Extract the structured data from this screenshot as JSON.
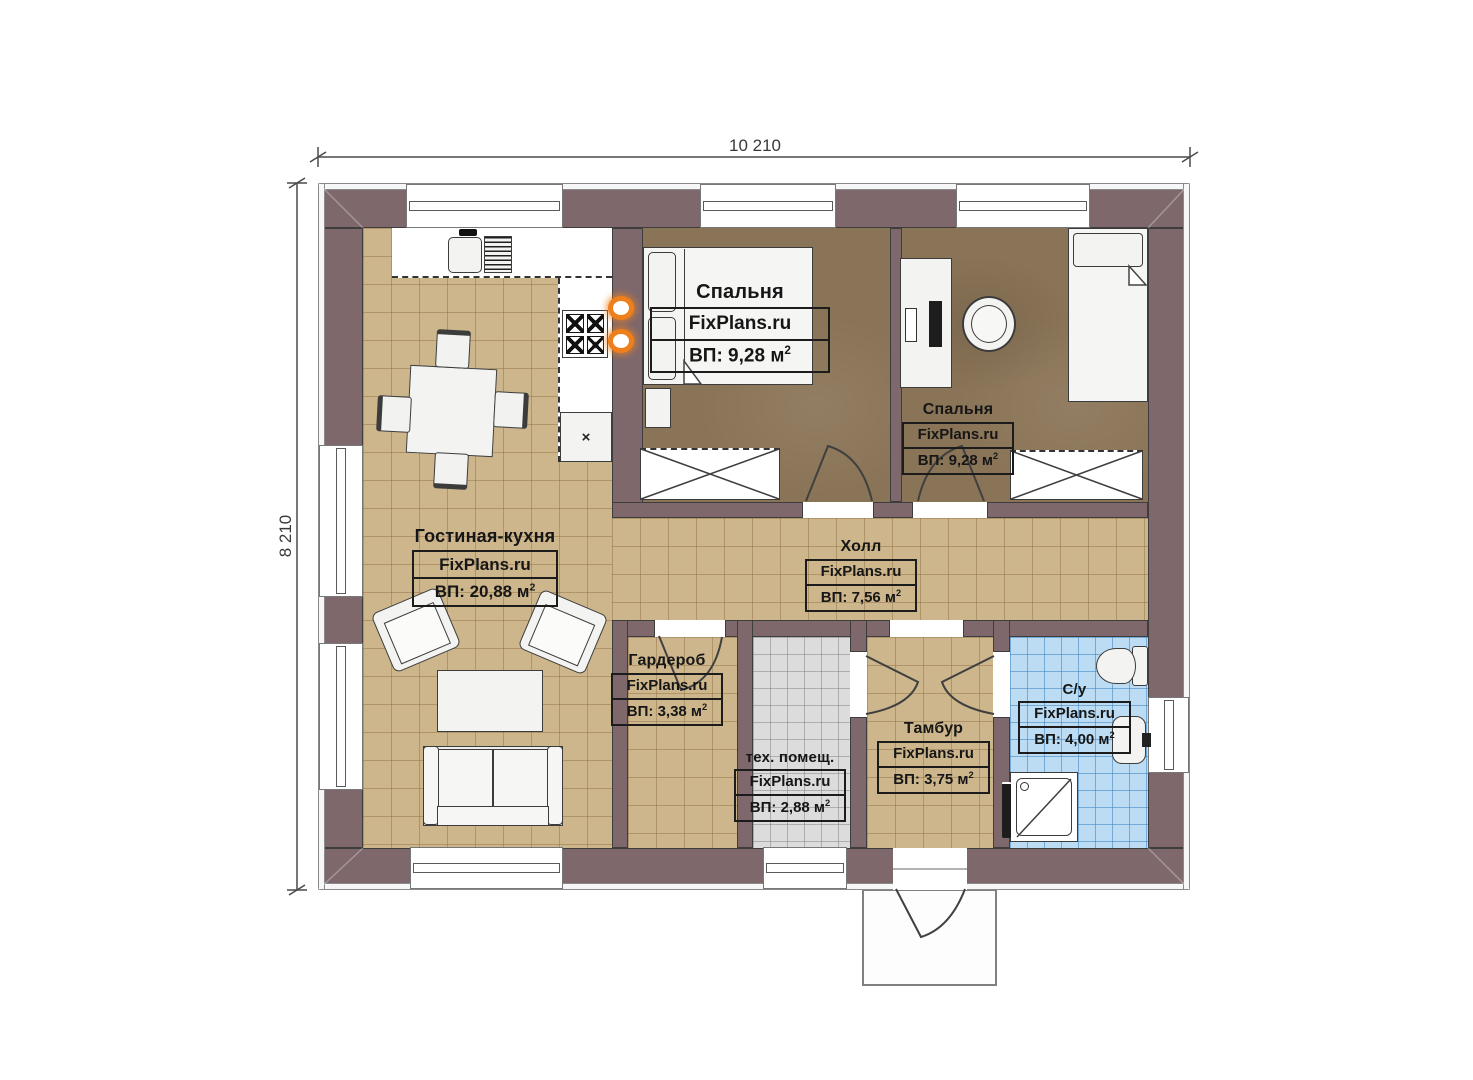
{
  "dimensions": {
    "width_label": "10 210",
    "height_label": "8 210"
  },
  "sup2": "2",
  "rooms": {
    "bedroom1": {
      "name": "Спальня",
      "brand": "FixPlans.ru",
      "area": "ВП: 9,28 м"
    },
    "bedroom2": {
      "name": "Спальня",
      "brand": "FixPlans.ru",
      "area": "ВП: 9,28 м"
    },
    "living": {
      "name": "Гостиная-кухня",
      "brand": "FixPlans.ru",
      "area": "ВП: 20,88 м"
    },
    "hall": {
      "name": "Холл",
      "brand": "FixPlans.ru",
      "area": "ВП: 7,56 м"
    },
    "wardrobe": {
      "name": "Гардероб",
      "brand": "FixPlans.ru",
      "area": "ВП: 3,38 м"
    },
    "tech": {
      "name": "тех. помещ.",
      "brand": "FixPlans.ru",
      "area": "ВП: 2,88 м"
    },
    "tambour": {
      "name": "Тамбур",
      "brand": "FixPlans.ru",
      "area": "ВП: 3,75 м"
    },
    "bathroom": {
      "name": "С/у",
      "brand": "FixPlans.ru",
      "area": "ВП: 4,00 м"
    }
  },
  "colors": {
    "wall": "#7e686c",
    "floor_living": "#cdb68c",
    "floor_bedroom": "#8a7457",
    "floor_bathroom": "#bcdcf4",
    "floor_tech": "#dcdcdc",
    "heater_accent": "#ef7f1a"
  }
}
